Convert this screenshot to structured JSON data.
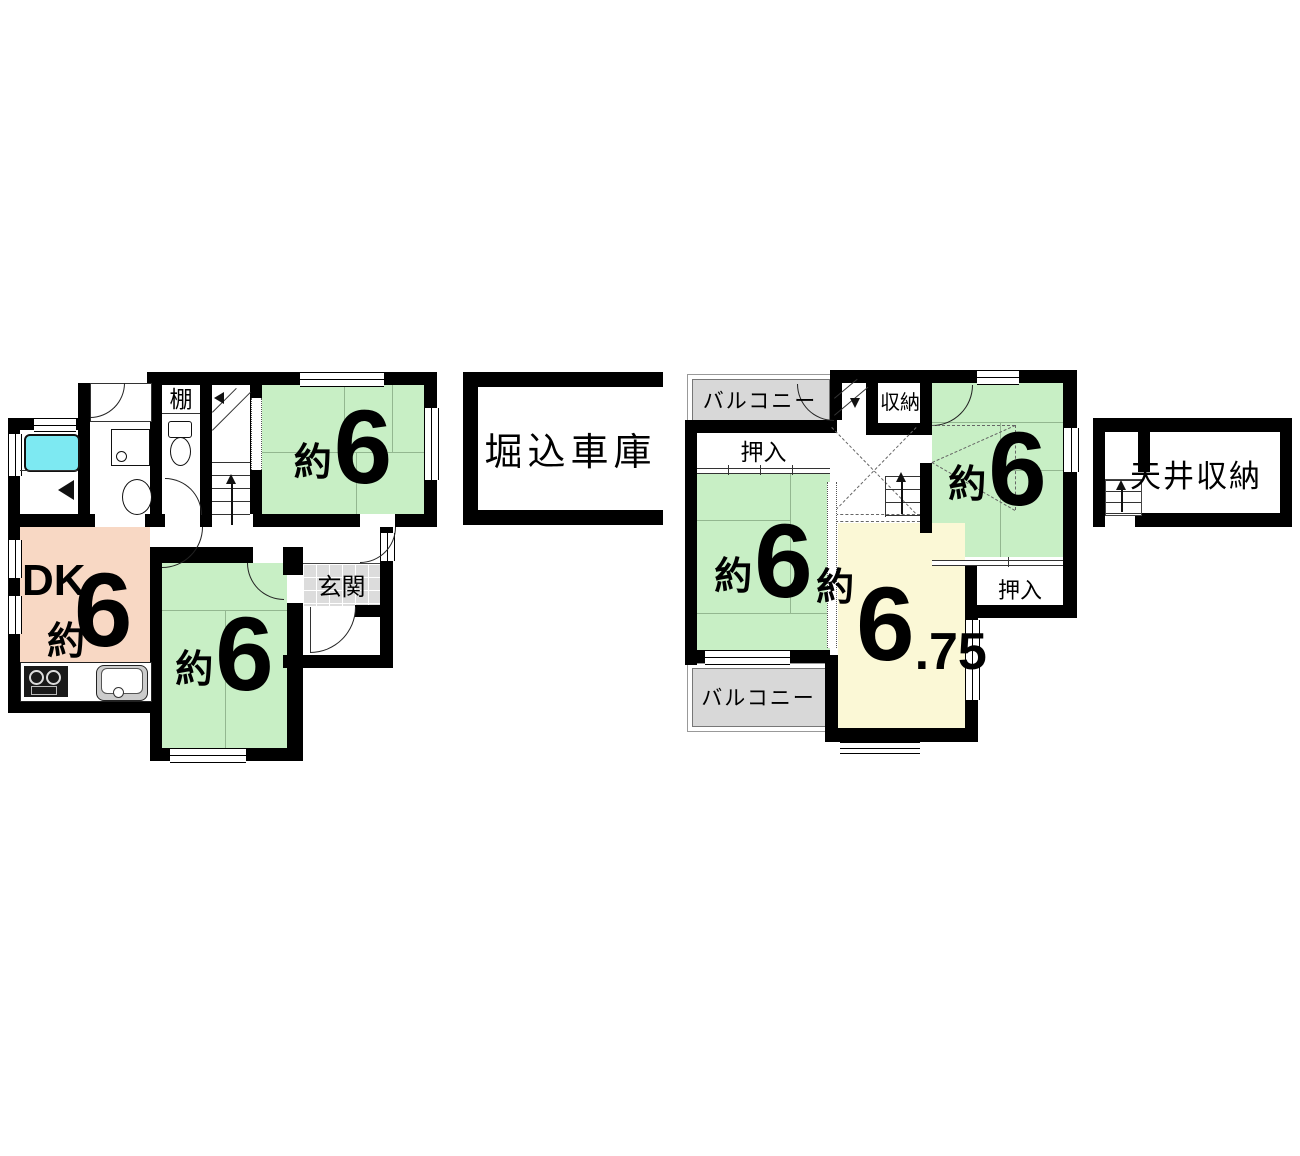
{
  "colors": {
    "wall_black": "#000000",
    "tatami_green": "#c8efc5",
    "tatami_line": "#93b790",
    "dk_salmon": "#f8d8c4",
    "room_yellow": "#fbf8d6",
    "balcony_gray": "#d8d8d8",
    "entrance_tile": "#dcdcdc",
    "bathtub_cyan": "#7de9f2"
  },
  "floor1": {
    "shelf_label": "棚",
    "tatami_room_top": {
      "approx": "約",
      "size": "6"
    },
    "tatami_room_bottom": {
      "approx": "約",
      "size": "6"
    },
    "dining_kitchen": {
      "name": "DK",
      "approx": "約",
      "size": "6"
    },
    "entrance_label": "玄関"
  },
  "garage": {
    "label": "堀込車庫"
  },
  "floor2": {
    "balcony_top_label": "バルコニー",
    "balcony_bottom_label": "バルコニー",
    "closet_top_label": "押入",
    "closet_right_label": "押入",
    "storage_label": "収納",
    "tatami_room_left": {
      "approx": "約",
      "size": "6"
    },
    "tatami_room_right": {
      "approx": "約",
      "size": "6"
    },
    "western_room": {
      "approx": "約",
      "size": "6",
      "fraction": ".75"
    }
  },
  "attic": {
    "label": "天井収納"
  }
}
